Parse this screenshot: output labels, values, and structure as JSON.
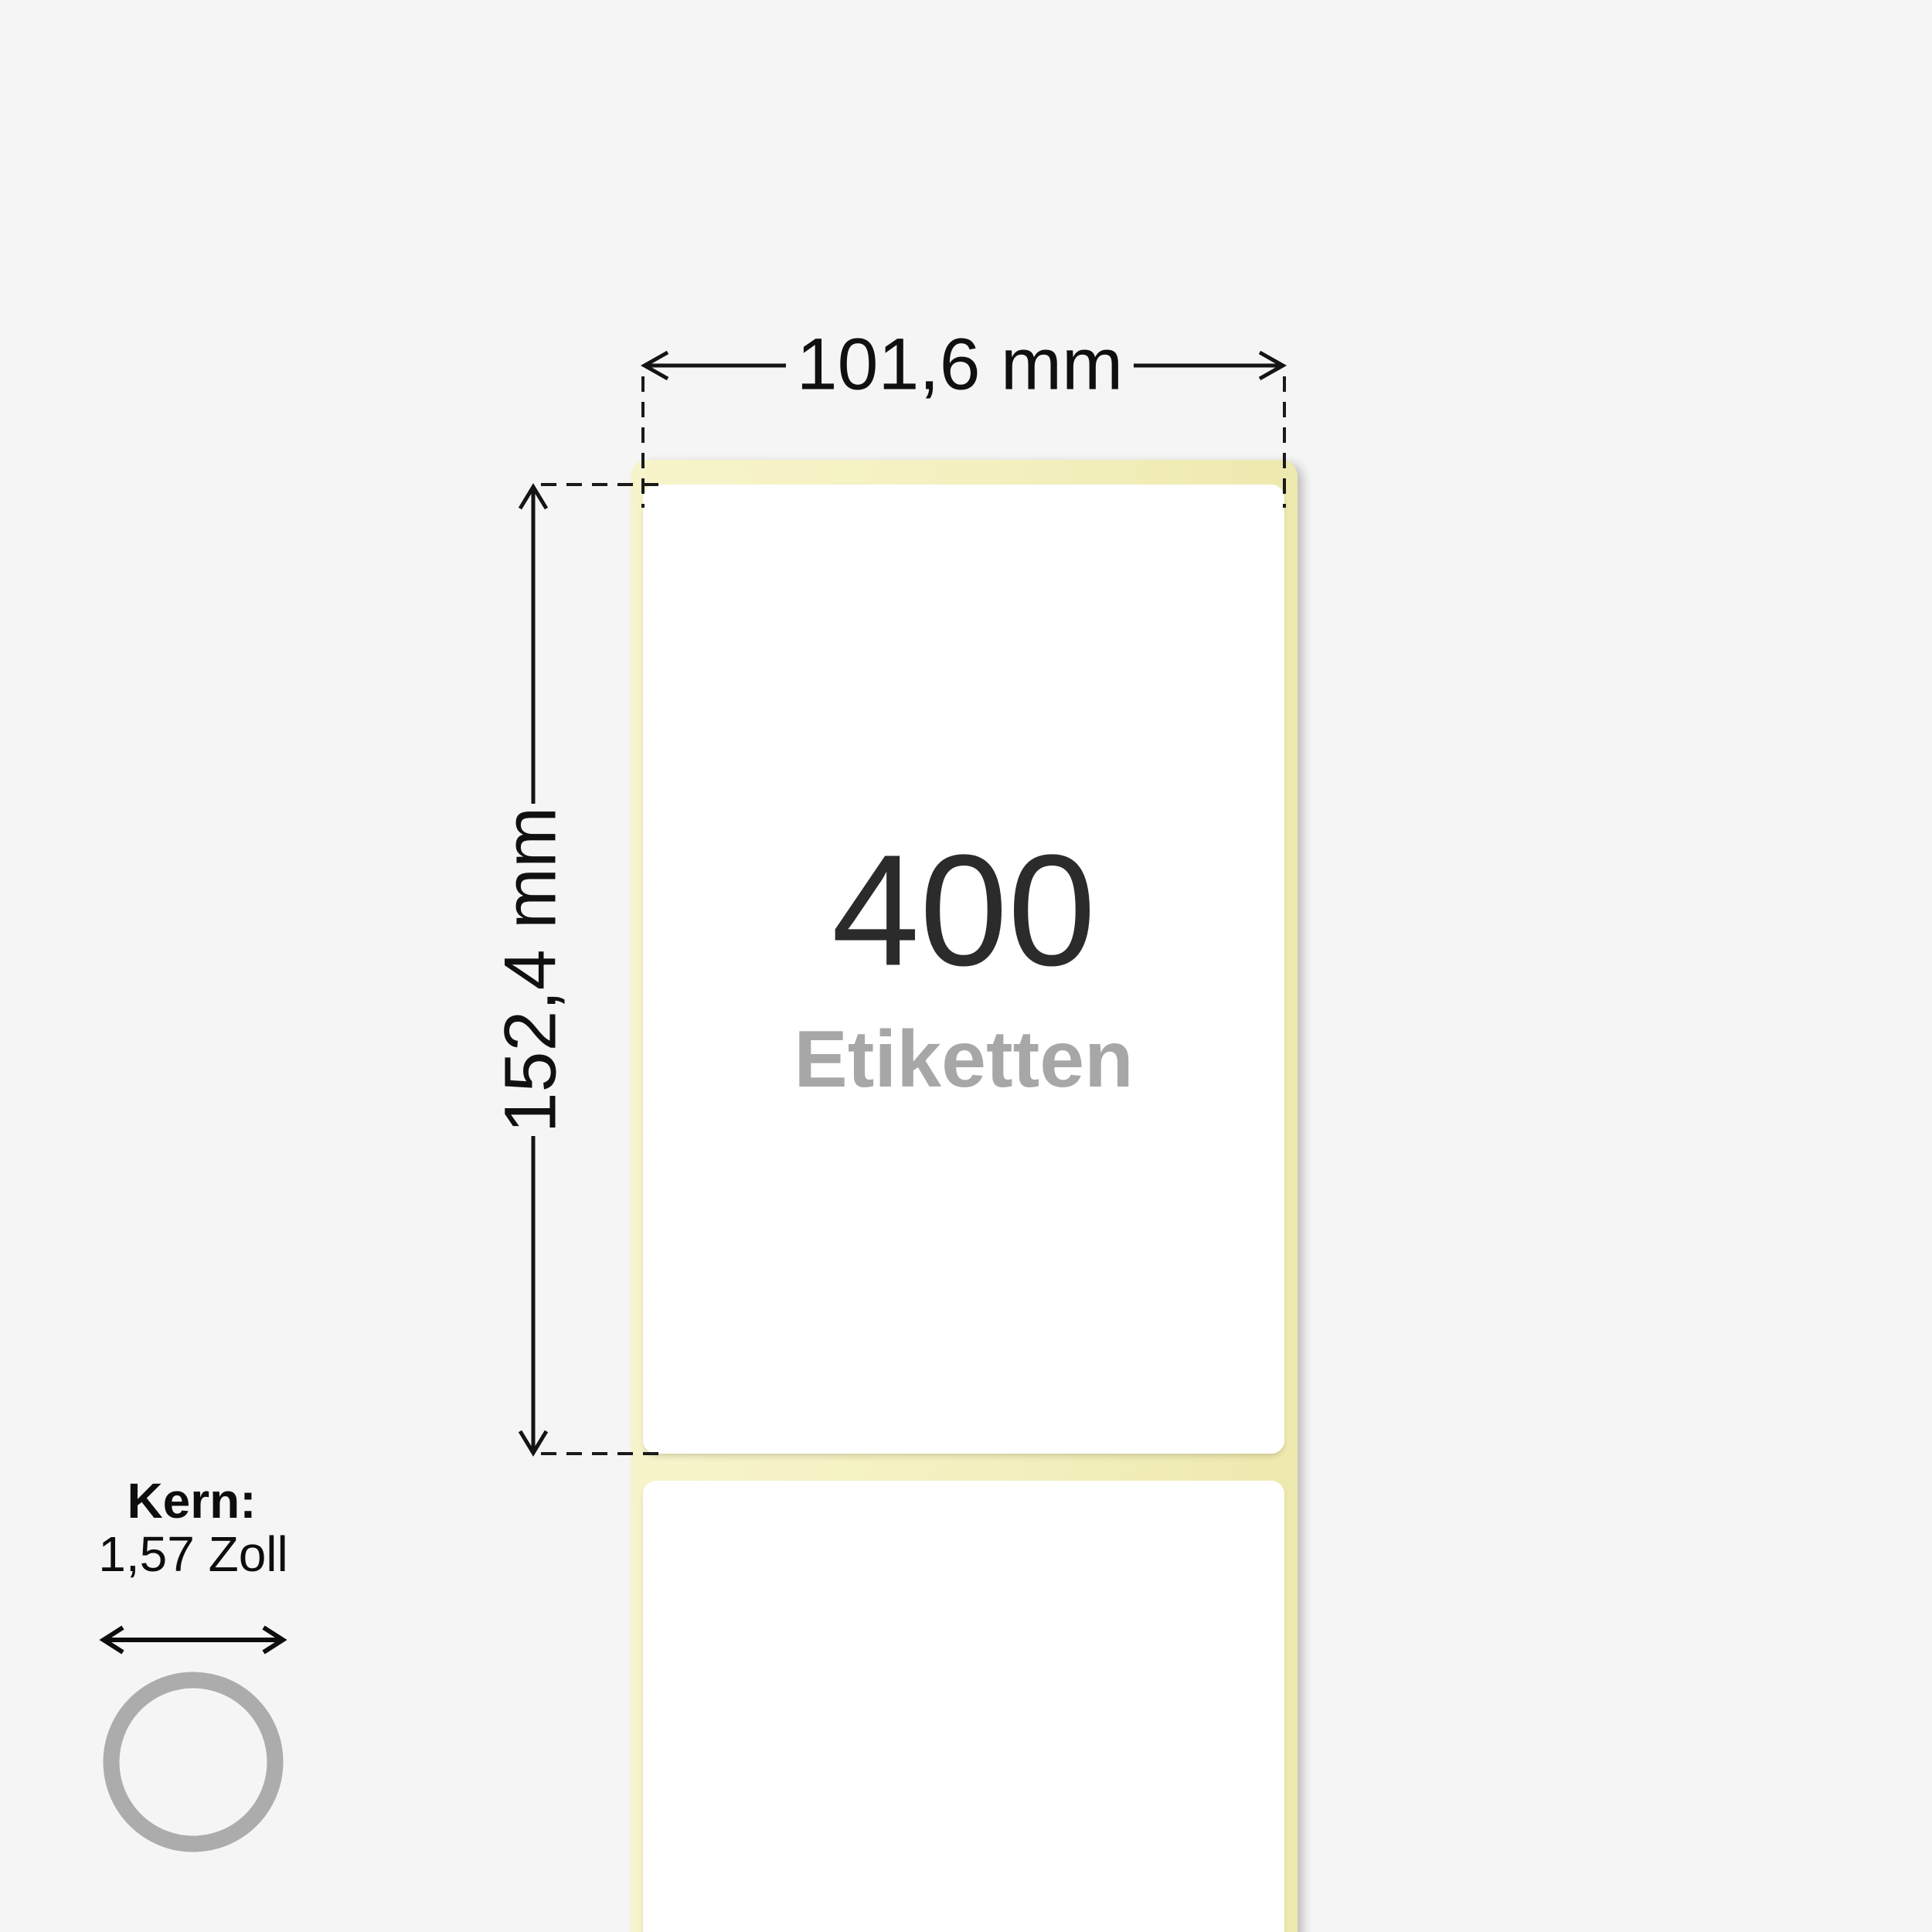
{
  "illustration": {
    "count": "400",
    "count_caption": "Etiketten",
    "width_dimension": "101,6 mm",
    "height_dimension": "152,4 mm",
    "core": {
      "title": "Kern:",
      "size": "1,57 Zoll"
    },
    "colors": {
      "background": "#f5f5f5",
      "liner_yellow": "#f4f0bf",
      "label_white": "#ffffff",
      "count_text": "#2b2b2b",
      "caption_text": "#a7a7a7",
      "annotation_line": "#141414",
      "core_ring": "#acacac"
    }
  }
}
